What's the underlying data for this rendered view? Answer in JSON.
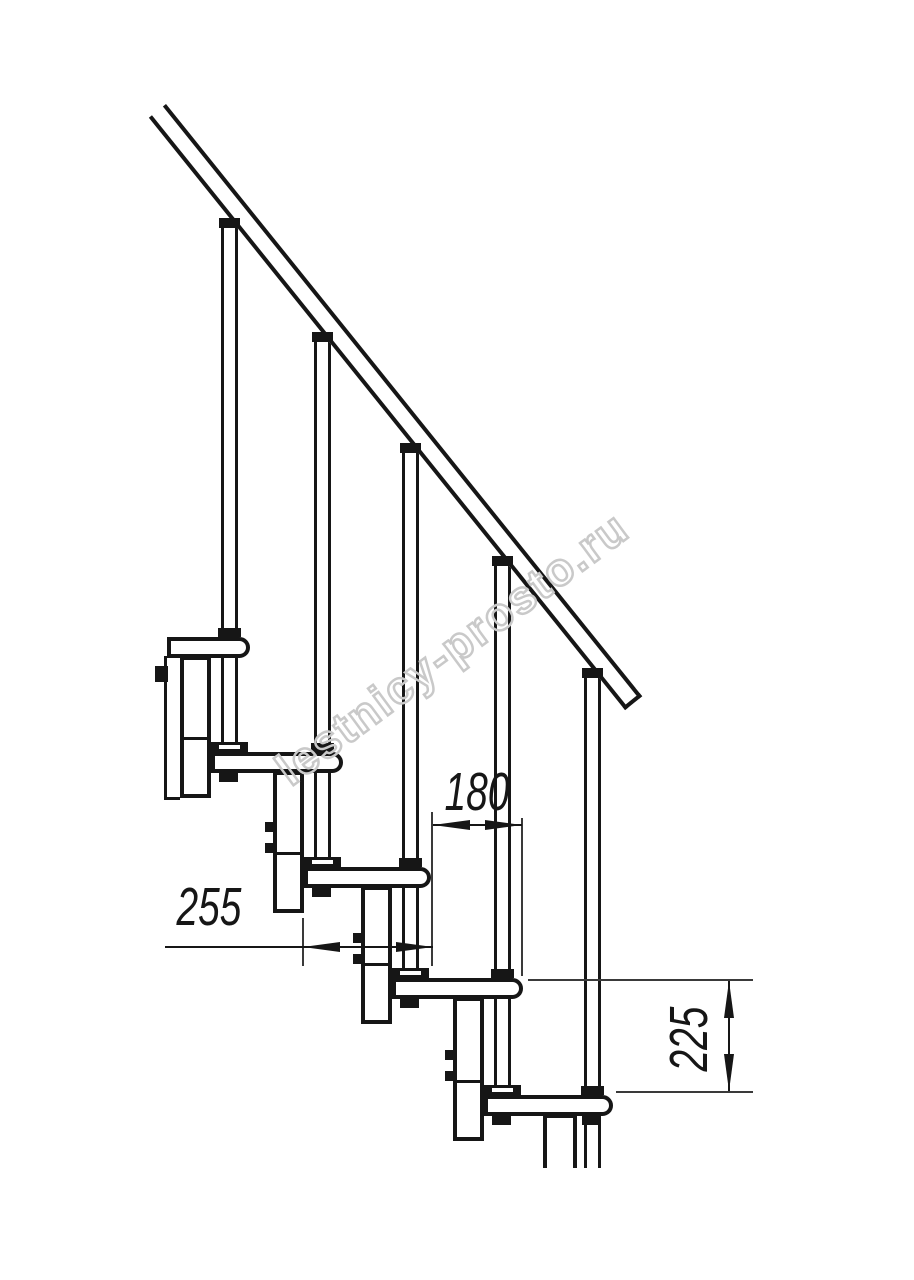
{
  "document": {
    "kind": "Technical drawing — side elevation of a modular staircase flight",
    "background": "#ffffff"
  },
  "watermark": {
    "text": "lestnicy-prosto.ru",
    "color": "#c9c9c9"
  },
  "dimensions": {
    "going": {
      "label": "180",
      "orientation": "horizontal"
    },
    "tread_length": {
      "label": "255",
      "orientation": "horizontal"
    },
    "riser": {
      "label": "225",
      "orientation": "vertical"
    }
  },
  "structure": {
    "tread_count": 5,
    "baluster_count": 5,
    "has_handrail": true
  },
  "colors": {
    "line": "#161616",
    "thin_line": "#3a3a3a",
    "background": "#ffffff"
  }
}
